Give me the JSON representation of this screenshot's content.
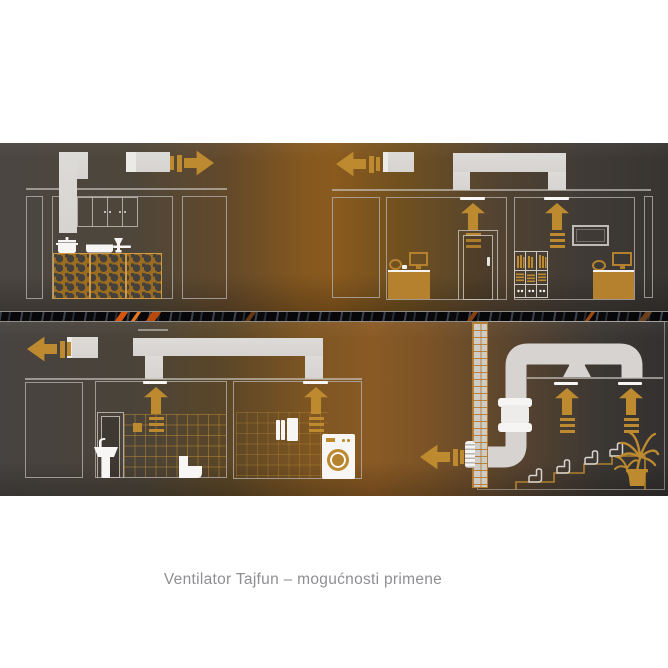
{
  "caption": {
    "text": "Ventilator Tajfun – mogućnosti primene"
  },
  "colors": {
    "accent": "#bd8a30",
    "furniture": "#b5812f",
    "duct": "#d6d3d0",
    "duct_light": "#eceae7",
    "outline": "#b3afaa",
    "vent": "#f7f6f4",
    "white": "#f7f6f4",
    "band_base": "#4b4642",
    "band_glow": "#8a5a1e",
    "band_dark": "#343130",
    "stripe_orange": "#e0590f",
    "caption_text": "#8e8e93"
  },
  "illustration": {
    "elements": [
      "airflow-right-arrow",
      "airflow-left-arrow",
      "airflow-up-arrow",
      "exhaust-duct",
      "ceiling-vent-strip",
      "kitchen-hood-duct",
      "wall-cabinets",
      "cooking-pot-icon",
      "frying-pan-icon",
      "wine-glass-icon",
      "honeycomb-counter",
      "office-desk",
      "computer-monitor-icon",
      "office-chair-icon",
      "door-icon",
      "bookshelf-icon",
      "picture-frame-icon",
      "bathroom-door",
      "sink-icon",
      "toilet-icon",
      "tiled-wall",
      "towels-icon",
      "washing-machine-icon",
      "brick-wall-column",
      "wall-grille-icon",
      "inline-duct-fan-icon",
      "duct-pipe",
      "cinema-seat-icon",
      "stepped-platform",
      "palm-plant-icon",
      "floor-separator-stripe"
    ]
  }
}
